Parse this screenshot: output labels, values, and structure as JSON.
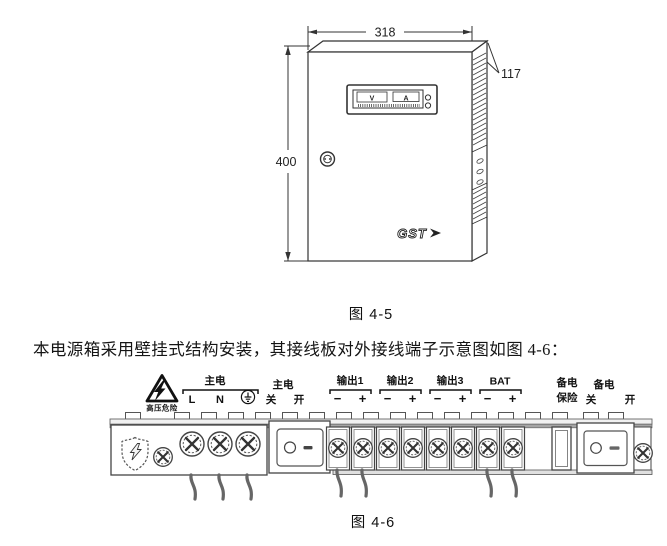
{
  "figure45": {
    "caption": "图 4-5",
    "dim_width": "318",
    "dim_depth": "117",
    "dim_height": "400",
    "meter_volt_label": "V",
    "meter_amp_label": "A",
    "logo_text": "GST"
  },
  "paragraph_text": "本电源箱采用壁挂式结构安装，其接线板对外接线端子示意图如图 4-6：",
  "figure46": {
    "caption": "图 4-6",
    "hazard_label": "高压危险",
    "mains_group": {
      "title": "主电",
      "live": "L",
      "neutral": "N",
      "ground_symbol": "⏚"
    },
    "mains_switch": {
      "title": "主电",
      "off": "关",
      "on": "开"
    },
    "output1": {
      "title": "输出1",
      "minus": "−",
      "plus": "+"
    },
    "output2": {
      "title": "输出2",
      "minus": "−",
      "plus": "+"
    },
    "output3": {
      "title": "输出3",
      "minus": "−",
      "plus": "+"
    },
    "battery": {
      "title": "BAT",
      "minus": "−",
      "plus": "+"
    },
    "backup_fuse": {
      "line1": "备电",
      "line2": "保险"
    },
    "backup_switch": {
      "title": "备电",
      "off": "关",
      "on": "开"
    }
  }
}
